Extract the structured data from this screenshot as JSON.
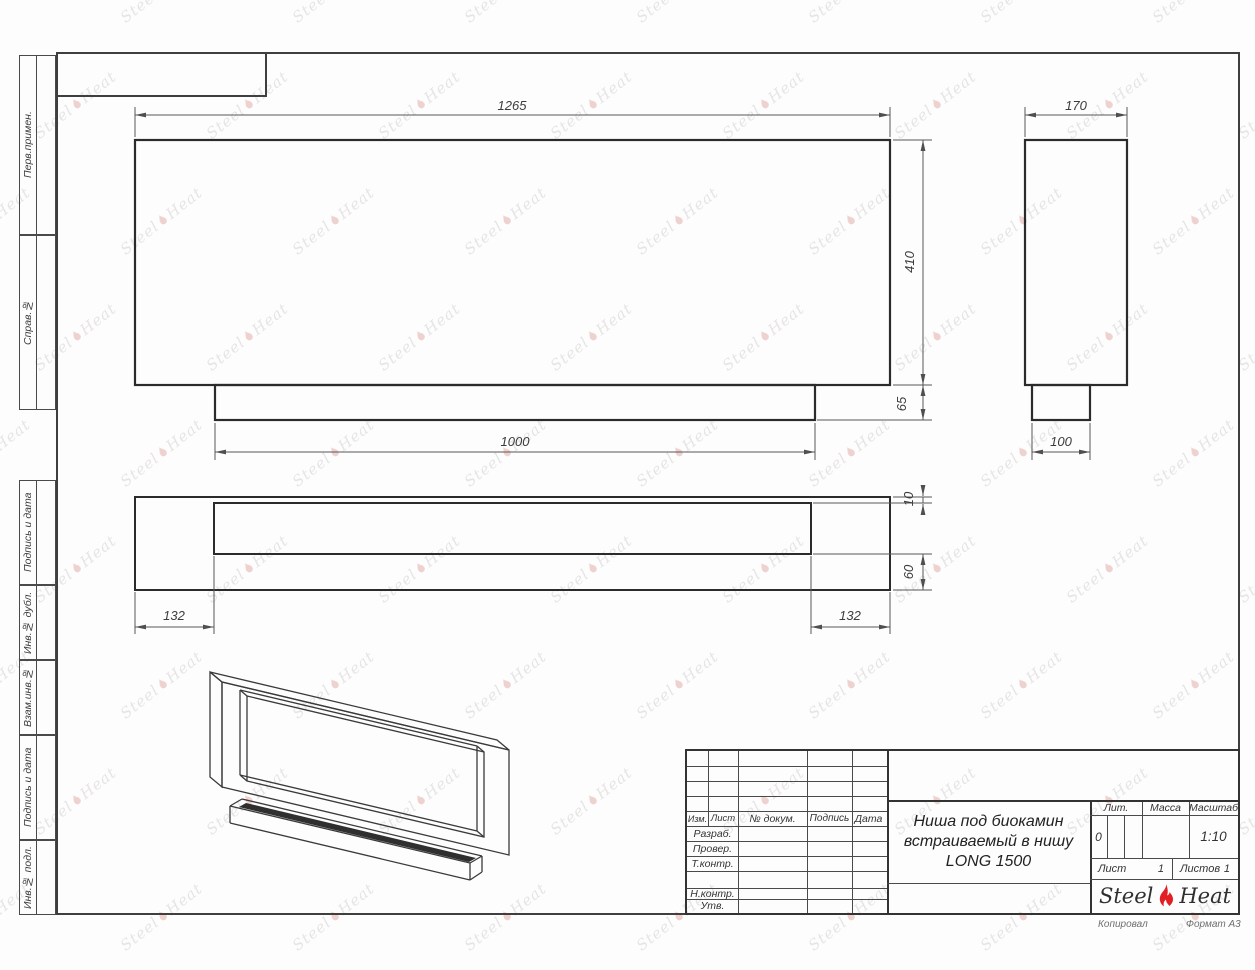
{
  "sheet": {
    "watermark": {
      "steel": "Steel",
      "heat": "Heat"
    },
    "below_frame": {
      "copied": "Копировал",
      "format": "Формат А3"
    }
  },
  "margin_labels": {
    "perv_primen": "Перв.примен.",
    "sprav_no": "Справ.№",
    "podpis_i_data": "Подпись и дата",
    "inv_dubl": "Инв.№ дубл.",
    "vzam_inv": "Взам.инв.№",
    "inv_podl": "Инв.№ подл."
  },
  "dimensions": {
    "front": {
      "width": "1265",
      "height": "410",
      "tab_height": "65",
      "tab_width": "1000"
    },
    "side": {
      "width": "170",
      "tab_width": "100"
    },
    "plan": {
      "top_gap": "10",
      "bottom_band": "60",
      "left_inset": "132",
      "right_inset": "132"
    }
  },
  "title_block": {
    "columns": {
      "izm": "Изм.",
      "list": "Лист",
      "dokum": "№ докум.",
      "podpis": "Подпись",
      "data": "Дата"
    },
    "rows": {
      "razrab": "Разраб.",
      "prover": "Провер.",
      "tkontr": "Т.контр.",
      "nkontr": "Н.контр.",
      "utv": "Утв."
    },
    "title_lines": [
      "Ниша под биокамин",
      "встраиваемый в нишу",
      "LONG 1500"
    ],
    "lit_label": "Лит.",
    "lit_value": "0",
    "massa_label": "Масса",
    "masshtab_label": "Масштаб",
    "masshtab_value": "1:10",
    "list_label": "Лист",
    "list_value": "1",
    "listov_label": "Листов",
    "listov_value": "1",
    "logo": {
      "steel": "Steel",
      "heat": "Heat"
    },
    "accent_color": "#e31e24"
  }
}
